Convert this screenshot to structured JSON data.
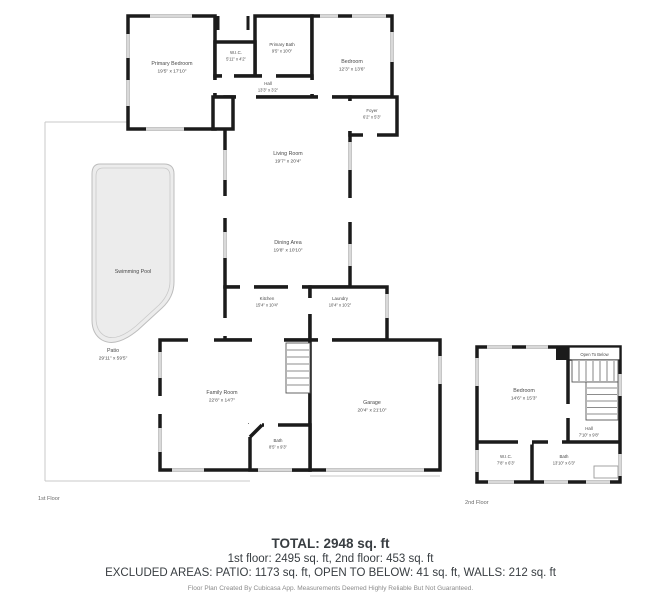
{
  "meta": {
    "floor1_label": "1st Floor",
    "floor2_label": "2nd Floor"
  },
  "rooms_floor1": {
    "primary_bedroom": {
      "name": "Primary Bedroom",
      "dims": "19'5\" x 17'10\""
    },
    "wic": {
      "name": "W.I.C.",
      "dims": "5'11\" x 4'2\""
    },
    "primary_bath": {
      "name": "Primary Bath",
      "dims": "9'5\" x 10'0\""
    },
    "bedroom": {
      "name": "Bedroom",
      "dims": "12'3\" x 13'6\""
    },
    "hall": {
      "name": "Hall",
      "dims": "13'3\" x 3'2\""
    },
    "foyer": {
      "name": "Foyer",
      "dims": "6'2\" x 5'3\""
    },
    "living_room": {
      "name": "Living Room",
      "dims": "19'7\" x 20'4\""
    },
    "dining_area": {
      "name": "Dining Area",
      "dims": "19'8\" x 10'10\""
    },
    "kitchen": {
      "name": "Kitchen",
      "dims": "15'4\" x 10'4\""
    },
    "laundry": {
      "name": "Laundry",
      "dims": "10'4\" x 10'2\""
    },
    "family_room": {
      "name": "Family Room",
      "dims": "22'8\" x 14'7\""
    },
    "bath": {
      "name": "Bath",
      "dims": "8'5\" x 9'3\""
    },
    "garage": {
      "name": "Garage",
      "dims": "20'4\" x 21'10\""
    },
    "swimming_pool": {
      "name": "Swimming Pool"
    },
    "patio": {
      "name": "Patio",
      "dims": "29'11\" x 59'5\""
    }
  },
  "rooms_floor2": {
    "open_to_below": {
      "name": "Open To Below"
    },
    "bedroom": {
      "name": "Bedroom",
      "dims": "14'6\" x 15'3\""
    },
    "hall": {
      "name": "Hall",
      "dims": "7'10\" x 9'8\""
    },
    "wic": {
      "name": "W.I.C.",
      "dims": "7'8\" x 6'3\""
    },
    "bath": {
      "name": "Bath",
      "dims": "13'10\" x 6'3\""
    }
  },
  "summary": {
    "total": "TOTAL: 2948 sq. ft",
    "floors": "1st floor: 2495 sq. ft, 2nd floor: 453 sq. ft",
    "excluded": "EXCLUDED AREAS: PATIO: 1173 sq. ft, OPEN TO BELOW: 41 sq. ft, WALLS: 212 sq. ft",
    "disclaimer": "Floor Plan Created By Cubicasa App. Measurements Deemed Highly Reliable But Not Guaranteed."
  },
  "colors": {
    "wall": "#1b1b1b",
    "window": "#d9d9d9",
    "pool_fill": "#ececec",
    "pool_edge": "#bdbdbd",
    "summary_text": "#383d41",
    "room_label": "#4a4a4a"
  }
}
